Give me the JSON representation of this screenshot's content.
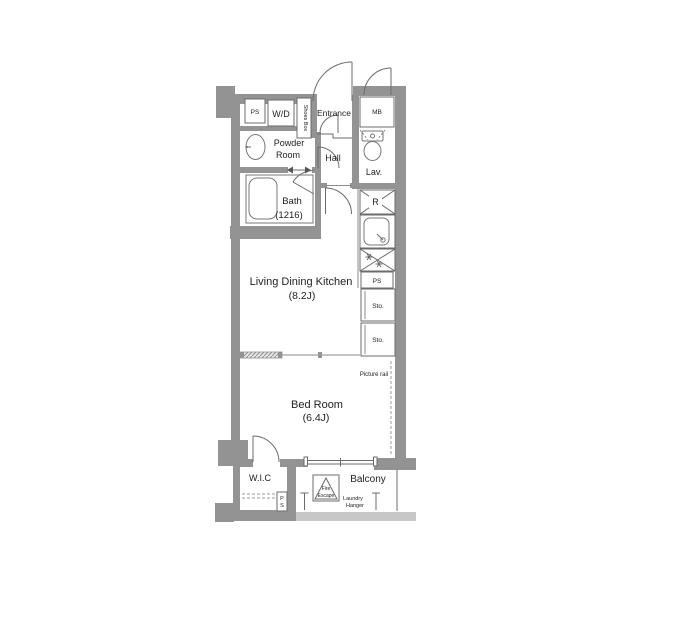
{
  "palette": {
    "wall": "#939393",
    "balcony_slab": "#c7c7c7",
    "line": "#6b6b6b",
    "dashed_line": "#999999",
    "text": "#222222",
    "background": "#ffffff"
  },
  "labels": {
    "ps_top": "PS",
    "washer_dryer": "W/D",
    "shoes_box": "Shoes Box",
    "entrance": "Entrance",
    "meter_box": "MB",
    "powder_line1": "Powder",
    "powder_line2": "Room",
    "hall": "Hall",
    "lavatory": "Lav.",
    "bath": "Bath",
    "bath_size": "(1216)",
    "refrigerator": "R",
    "ps_kitchen": "PS",
    "storage1": "Sto.",
    "storage2": "Sto.",
    "ldk": "Living Dining Kitchen",
    "ldk_size": "(8.2J)",
    "picture_rail": "Picture rail",
    "bedroom": "Bed Room",
    "bedroom_size": "(6.4J)",
    "wic": "W.I.C",
    "ps_wic_p": "P",
    "ps_wic_s": "S",
    "balcony": "Balcony",
    "fire_line1": "Fire",
    "fire_line2": "Escape",
    "laundry_line1": "Laundry",
    "laundry_line2": "Hanger"
  }
}
